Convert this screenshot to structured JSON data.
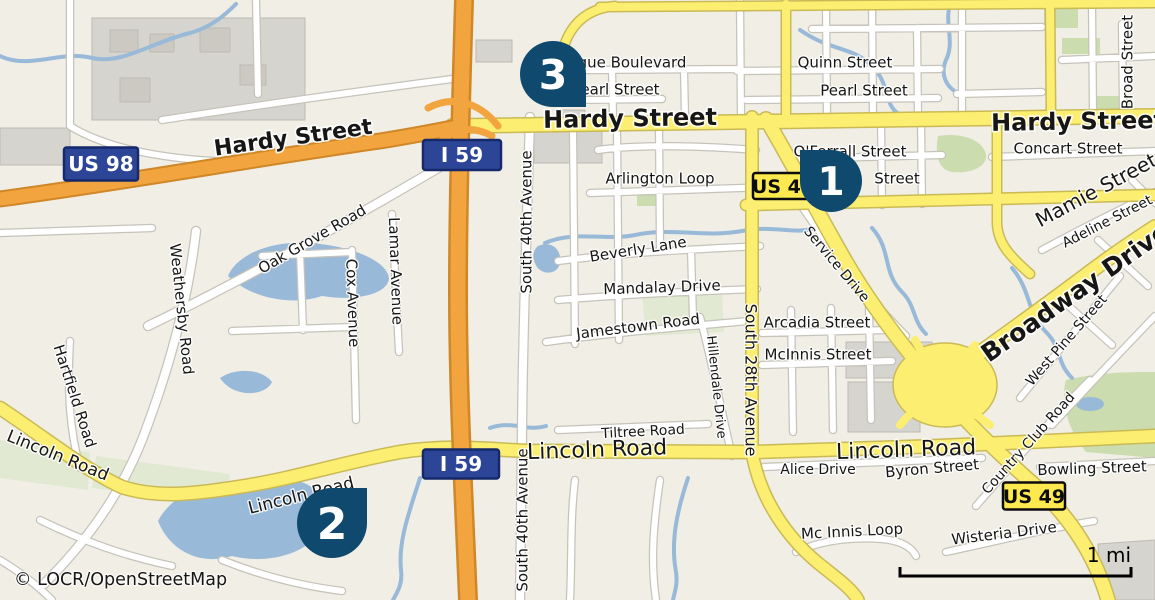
{
  "attribution": "© LOCR/OpenStreetMap",
  "scale_bar": {
    "label": "1 mi"
  },
  "colors": {
    "background": "#f1eee6",
    "road_yellow": "#fcee71",
    "road_yellow_casing": "#c9ba55",
    "road_orange": "#f2a43e",
    "road_orange_casing": "#cf8728",
    "road_white": "#ffffff",
    "road_white_casing": "#c6c3bb",
    "water": "#99b9d8",
    "green": "#cbdcae",
    "gray_area": "#d6d4ce",
    "marker": "#0f4a6e",
    "shield_blue": "#2c4596",
    "shield_blue_border": "#15296b",
    "shield_yellow": "#fce84f",
    "label_color": "#161616"
  },
  "markers": [
    {
      "number": "1",
      "cx": 831,
      "cy": 181,
      "r": 31,
      "tail": "top-left",
      "rot": 0
    },
    {
      "number": "2",
      "cx": 332,
      "cy": 523,
      "r": 35,
      "tail": "top-right",
      "rot": 90
    },
    {
      "number": "3",
      "cx": 553,
      "cy": 74,
      "r": 33,
      "tail": "bottom-right",
      "rot": 180
    }
  ],
  "shields": [
    {
      "text": "US 98",
      "style": "blue",
      "cx": 101,
      "cy": 164,
      "w": 74,
      "h": 33
    },
    {
      "text": "I 59",
      "style": "blue",
      "cx": 462,
      "cy": 155,
      "w": 78,
      "h": 30
    },
    {
      "text": "I 59",
      "style": "blue",
      "cx": 461,
      "cy": 464,
      "w": 76,
      "h": 29
    },
    {
      "text": "US 49",
      "style": "yellow",
      "cx": 783,
      "cy": 186,
      "w": 60,
      "h": 26
    },
    {
      "text": "US 49",
      "style": "yellow",
      "cx": 1034,
      "cy": 496,
      "w": 62,
      "h": 27
    }
  ],
  "street_labels": [
    {
      "text": "Hardy Street",
      "x": 293,
      "y": 137,
      "rot": -8,
      "size": 22,
      "bold": true
    },
    {
      "text": "Hardy Street",
      "x": 630,
      "y": 118,
      "rot": -1,
      "size": 24,
      "bold": true
    },
    {
      "text": "Hardy Street",
      "x": 1078,
      "y": 121,
      "rot": -1,
      "size": 24,
      "bold": true
    },
    {
      "text": "Quinn Street",
      "x": 845,
      "y": 62,
      "rot": 0,
      "size": 15
    },
    {
      "text": "Pearl Street",
      "x": 864,
      "y": 90,
      "rot": 0,
      "size": 15
    },
    {
      "text": "gue Boulevard",
      "x": 632,
      "y": 62,
      "rot": 0,
      "size": 15
    },
    {
      "text": "earl Street",
      "x": 620,
      "y": 89,
      "rot": 0,
      "size": 15
    },
    {
      "text": "Broad Street",
      "x": 1127,
      "y": 62,
      "rot": -90,
      "size": 15
    },
    {
      "text": "Concart Street",
      "x": 1068,
      "y": 148,
      "rot": 0,
      "size": 15
    },
    {
      "text": "Mamie Street",
      "x": 1096,
      "y": 190,
      "rot": -28,
      "size": 20
    },
    {
      "text": "Adeline Street",
      "x": 1107,
      "y": 221,
      "rot": -27,
      "size": 14
    },
    {
      "text": "Broadway Drive",
      "x": 1075,
      "y": 292,
      "rot": -35,
      "size": 25,
      "bold": true
    },
    {
      "text": "O'Ferrall Street",
      "x": 850,
      "y": 151,
      "rot": 0,
      "size": 15
    },
    {
      "text": "Street",
      "x": 897,
      "y": 178,
      "rot": 0,
      "size": 15
    },
    {
      "text": "Arlington Loop",
      "x": 660,
      "y": 178,
      "rot": 0,
      "size": 15
    },
    {
      "text": "Service Drive",
      "x": 837,
      "y": 264,
      "rot": 50,
      "size": 14
    },
    {
      "text": "Beverly Lane",
      "x": 638,
      "y": 249,
      "rot": -9,
      "size": 15
    },
    {
      "text": "Mandalay Drive",
      "x": 662,
      "y": 287,
      "rot": -2,
      "size": 15
    },
    {
      "text": "Jamestown Road",
      "x": 638,
      "y": 326,
      "rot": -7,
      "size": 15
    },
    {
      "text": "Arcadia Street",
      "x": 817,
      "y": 322,
      "rot": 0,
      "size": 15
    },
    {
      "text": "McInnis Street",
      "x": 818,
      "y": 354,
      "rot": 0,
      "size": 15
    },
    {
      "text": "South 28th Avenue",
      "x": 751,
      "y": 380,
      "rot": 90,
      "size": 16
    },
    {
      "text": "Hillendale Drive",
      "x": 717,
      "y": 387,
      "rot": 84,
      "size": 13
    },
    {
      "text": "South 40th Avenue",
      "x": 526,
      "y": 222,
      "rot": -90,
      "size": 15
    },
    {
      "text": "South 40th Avenue",
      "x": 522,
      "y": 520,
      "rot": -90,
      "size": 15
    },
    {
      "text": "Cox Avenue",
      "x": 353,
      "y": 303,
      "rot": 88,
      "size": 15
    },
    {
      "text": "Lamar Avenue",
      "x": 396,
      "y": 271,
      "rot": 88,
      "size": 15
    },
    {
      "text": "Oak Grove Road",
      "x": 312,
      "y": 239,
      "rot": -30,
      "size": 15
    },
    {
      "text": "Weathersby Road",
      "x": 182,
      "y": 309,
      "rot": 84,
      "size": 15
    },
    {
      "text": "Hartfield Road",
      "x": 75,
      "y": 396,
      "rot": 72,
      "size": 15
    },
    {
      "text": "Lincoln Road",
      "x": 58,
      "y": 455,
      "rot": 22,
      "size": 17
    },
    {
      "text": "Lincoln Road",
      "x": 301,
      "y": 495,
      "rot": -14,
      "size": 17
    },
    {
      "text": "Lincoln Road",
      "x": 597,
      "y": 449,
      "rot": -2,
      "size": 22
    },
    {
      "text": "Lincoln Road",
      "x": 906,
      "y": 449,
      "rot": -2,
      "size": 22
    },
    {
      "text": "Tiltree Road",
      "x": 643,
      "y": 431,
      "rot": -3,
      "size": 14
    },
    {
      "text": "Alice Drive",
      "x": 818,
      "y": 469,
      "rot": 0,
      "size": 14
    },
    {
      "text": "Byron Street",
      "x": 932,
      "y": 468,
      "rot": -5,
      "size": 15
    },
    {
      "text": "Country Club Road",
      "x": 1028,
      "y": 443,
      "rot": -48,
      "size": 14
    },
    {
      "text": "Bowling Street",
      "x": 1092,
      "y": 468,
      "rot": -2,
      "size": 15
    },
    {
      "text": "West Pine Street",
      "x": 1066,
      "y": 340,
      "rot": -49,
      "size": 14
    },
    {
      "text": "Wisteria Drive",
      "x": 1004,
      "y": 533,
      "rot": -7,
      "size": 15
    },
    {
      "text": "Mc Innis Loop",
      "x": 852,
      "y": 531,
      "rot": -3,
      "size": 15
    }
  ]
}
